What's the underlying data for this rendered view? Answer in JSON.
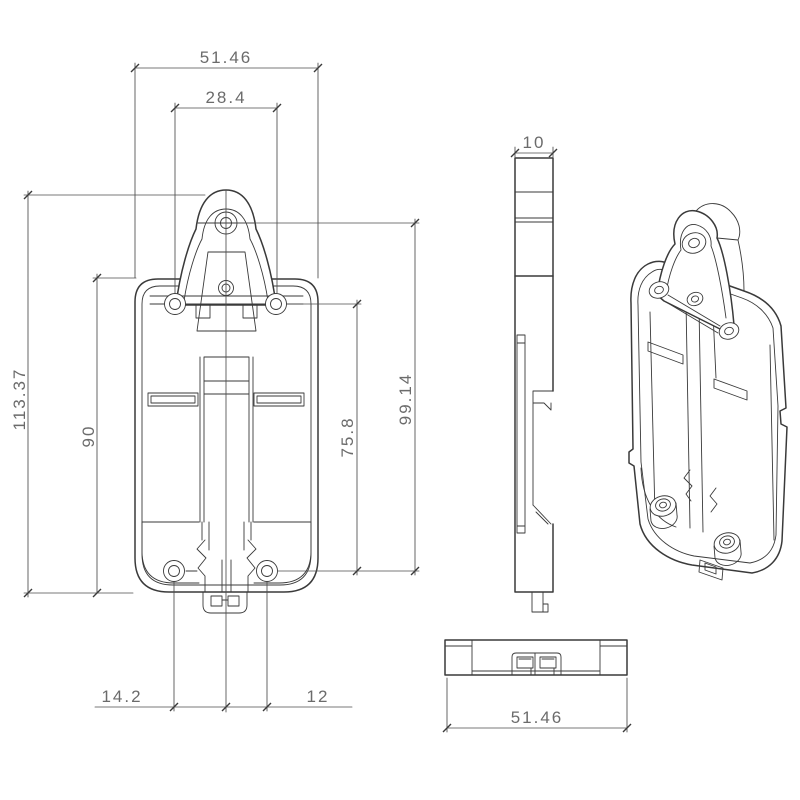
{
  "drawing": {
    "type": "engineering-drawing",
    "subject": "DIN-rail mounting bracket",
    "colors": {
      "background": "#ffffff",
      "part_line": "#3a3a3a",
      "dimension_line": "#4d4d4d",
      "dimension_text": "#6b6b6b"
    }
  },
  "dims": {
    "front_overall_width": "51.46",
    "front_hole_spacing": "28.4",
    "front_overall_height": "113.37",
    "front_body_height": "90",
    "front_hole_span": "75.8",
    "front_tab_to_hole": "99.14",
    "front_bottom_left_offset": "14.2",
    "front_bottom_right_offset": "12",
    "side_thickness": "10",
    "bottom_overall_width": "51.46"
  }
}
